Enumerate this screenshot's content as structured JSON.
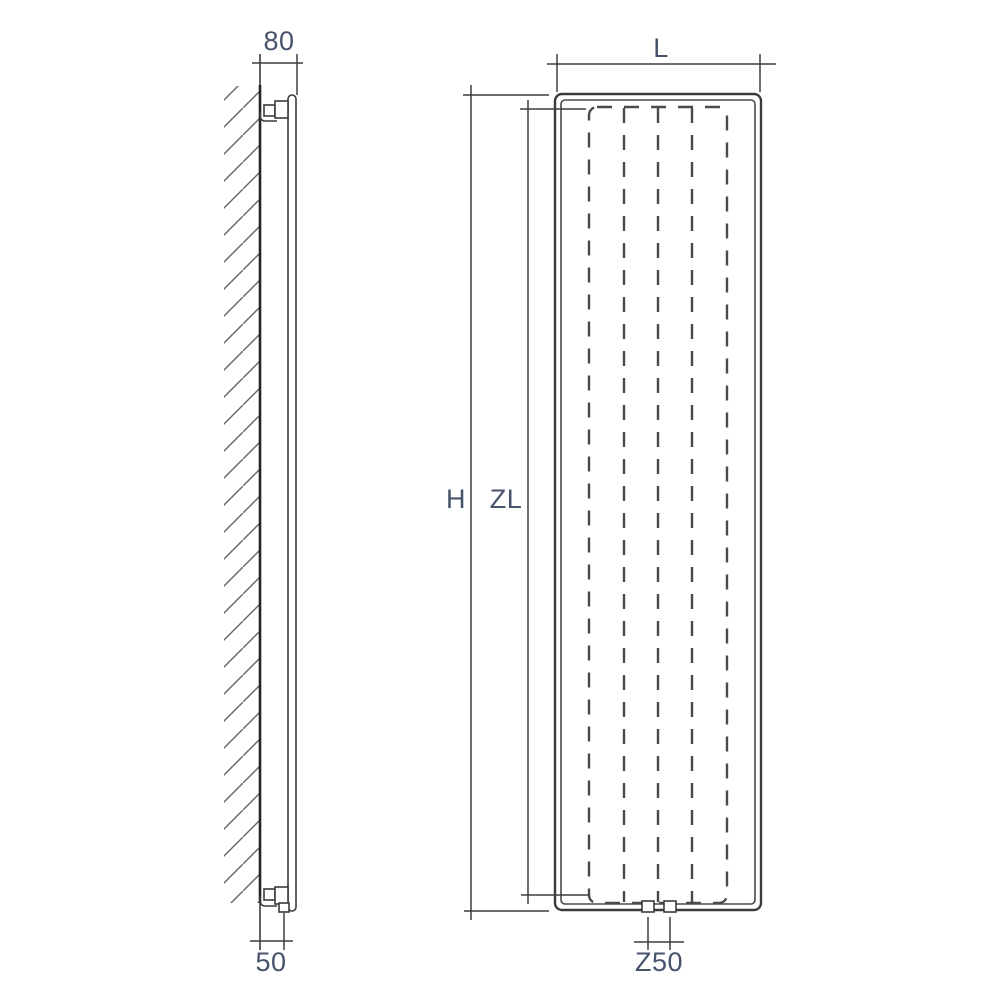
{
  "drawing": {
    "side_view": {
      "dim_wall_to_front": "80",
      "dim_wall_to_pipe": "50"
    },
    "front_view": {
      "dim_width": "L",
      "dim_height": "H",
      "dim_inner_height": "ZL",
      "dim_pipe_spacing": "Z50"
    },
    "colors": {
      "line": "#3b3b3b",
      "dash": "#4a4a4a",
      "hatch": "#666666",
      "dimension_text": "#46536b",
      "background": "#ffffff"
    }
  }
}
